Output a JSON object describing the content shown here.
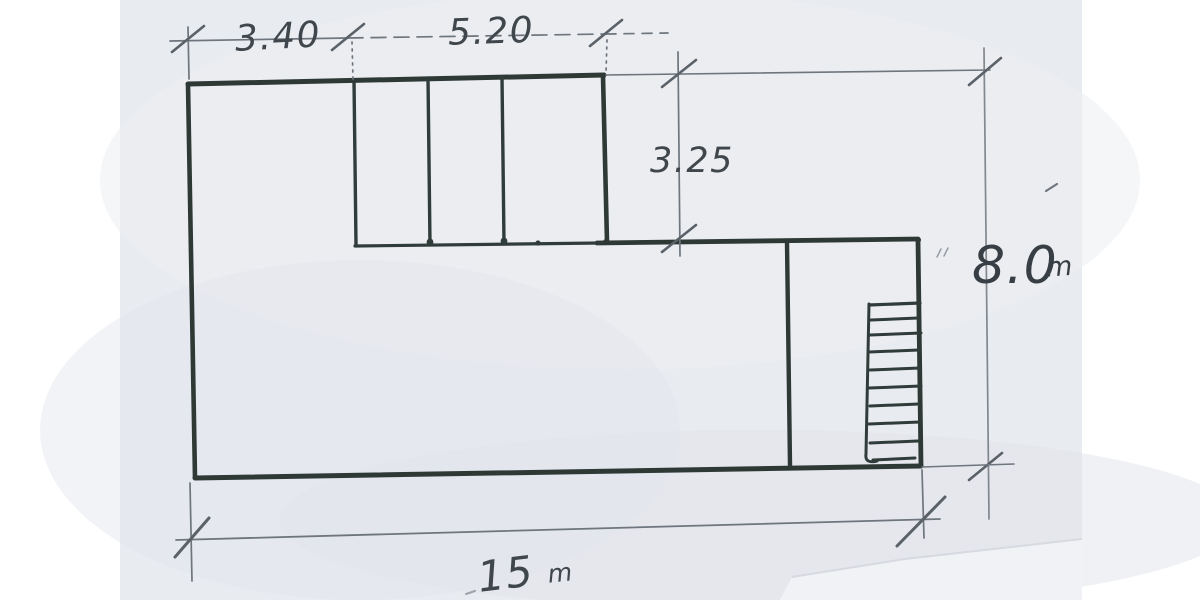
{
  "sketch": {
    "kind": "hand-drawn floor-plan sketch with dimension lines",
    "dimensions": {
      "top_left_width": "3.40",
      "top_right_width": "5.20",
      "upper_section_height": "3.25",
      "right_height_value": "8.0",
      "right_height_unit": "m",
      "bottom_width_value": "15",
      "bottom_width_unit": "m"
    },
    "colors": {
      "paper": "#e8ebf0",
      "margin": "#ffffff",
      "ink": "#2e3936",
      "pencil": "#6e757d",
      "handwriting": "#3f464c"
    }
  }
}
